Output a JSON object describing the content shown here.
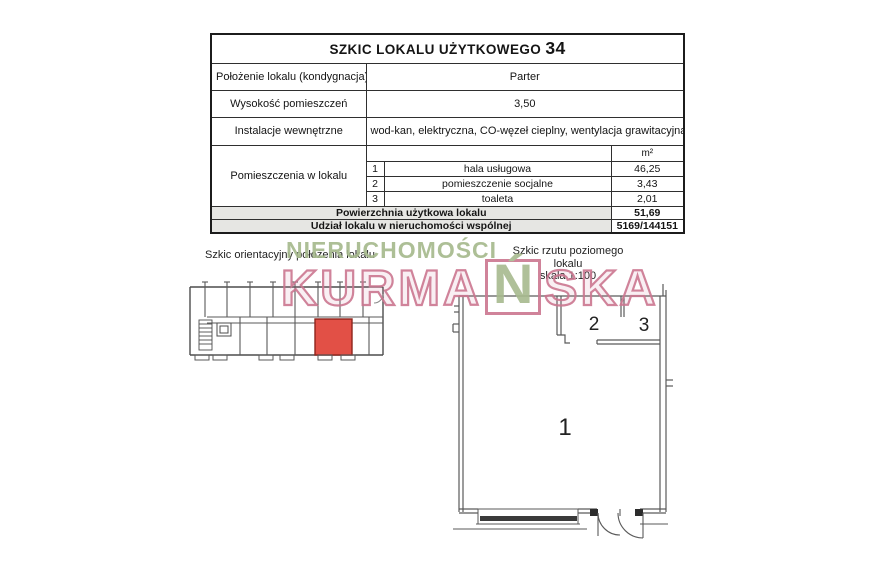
{
  "document": {
    "title": {
      "main": "SZKIC LOKALU UŻYTKOWEGO",
      "number": "34"
    },
    "info_rows": [
      {
        "label": "Położenie lokalu (kondygnacja)",
        "value": "Parter"
      },
      {
        "label": "Wysokość pomieszczeń",
        "value": "3,50"
      },
      {
        "label": "Instalacje wewnętrzne",
        "value": "wod-kan, elektryczna, CO-węzeł cieplny, wentylacja grawitacyjna"
      }
    ],
    "rooms_section": {
      "label": "Pomieszczenia w lokalu",
      "unit_header": "m²",
      "rooms": [
        {
          "no": "1",
          "name": "hala usługowa",
          "area": "46,25"
        },
        {
          "no": "2",
          "name": "pomieszczenie socjalne",
          "area": "3,43"
        },
        {
          "no": "3",
          "name": "toaleta",
          "area": "2,01"
        }
      ]
    },
    "summary_rows": [
      {
        "label": "Powierzchnia użytkowa lokalu",
        "value": "51,69"
      },
      {
        "label": "Udział lokalu w nieruchomości wspólnej",
        "value": "5169/144151"
      }
    ],
    "captions": {
      "left": "Szkic orientacyjny położenia lokalu",
      "right_line1": "Szkic rzutu poziomego lokalu",
      "right_line2": "skala 1:100"
    },
    "watermark": {
      "line1": "NIERUCHOMOŚCI",
      "line2_prefix": "KURMA",
      "line2_boxed": "Ń",
      "line2_suffix": "SKA",
      "green_color": "#a7ba8e",
      "pink_color": "#cb7690"
    },
    "floor_plan": {
      "room1_label": "1",
      "room2_label": "2",
      "room3_label": "3",
      "highlight_color": "#e25046"
    }
  }
}
